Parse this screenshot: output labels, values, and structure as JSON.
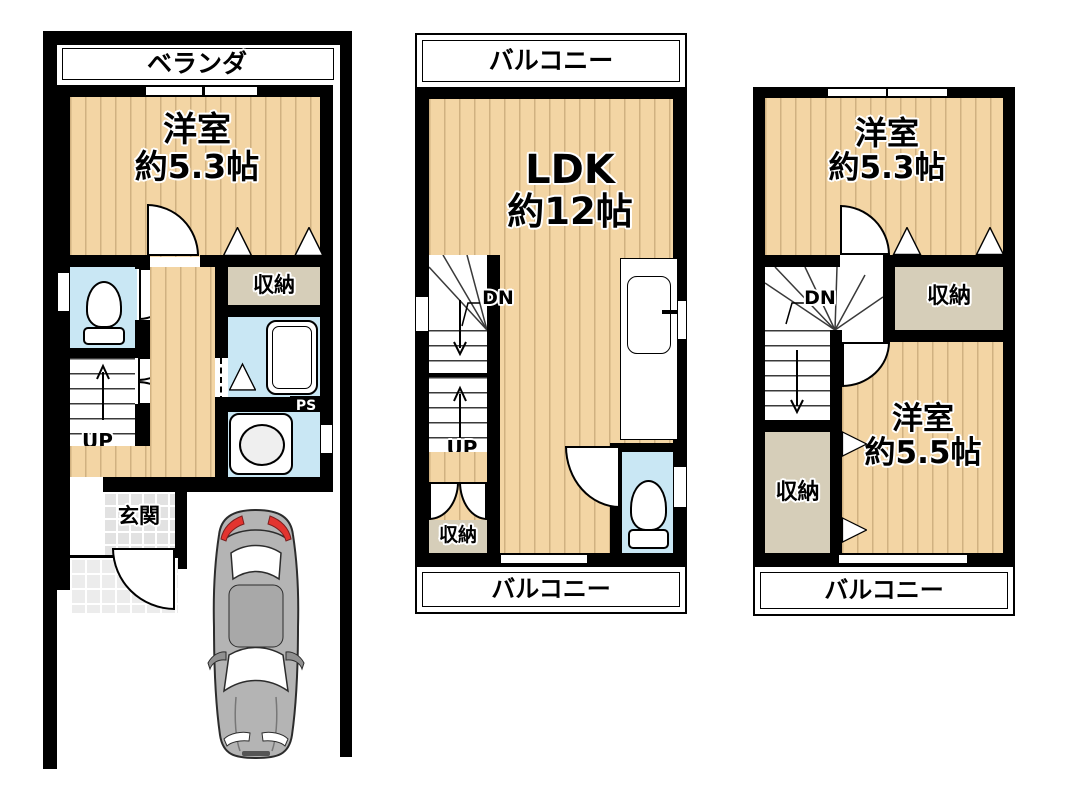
{
  "floor1": {
    "veranda": "ベランダ",
    "room": {
      "name": "洋室",
      "size": "約5.3帖"
    },
    "closet": "収納",
    "up": "UP",
    "entrance": "玄関",
    "ps": "PS"
  },
  "floor2": {
    "balcony_top": "バルコニー",
    "ldk": {
      "name": "LDK",
      "size": "約12帖"
    },
    "dn": "DN",
    "up": "UP",
    "closet": "収納",
    "balcony_bottom": "バルコニー"
  },
  "floor3": {
    "room_top": {
      "name": "洋室",
      "size": "約5.3帖"
    },
    "closet_top": "収納",
    "dn": "DN",
    "closet_bottom": "収納",
    "room_bottom": {
      "name": "洋室",
      "size": "約5.5帖"
    },
    "balcony": "バルコニー"
  },
  "colors": {
    "floor": "#F3D5A4",
    "floor_stripe": "#967648",
    "closet": "#D6CEB9",
    "water_room": "#C9E7F4",
    "wall": "#000000",
    "entrance_tile": "#E2E2E2",
    "car_body": "#B4B4B4",
    "tail_light": "#E3342F"
  }
}
